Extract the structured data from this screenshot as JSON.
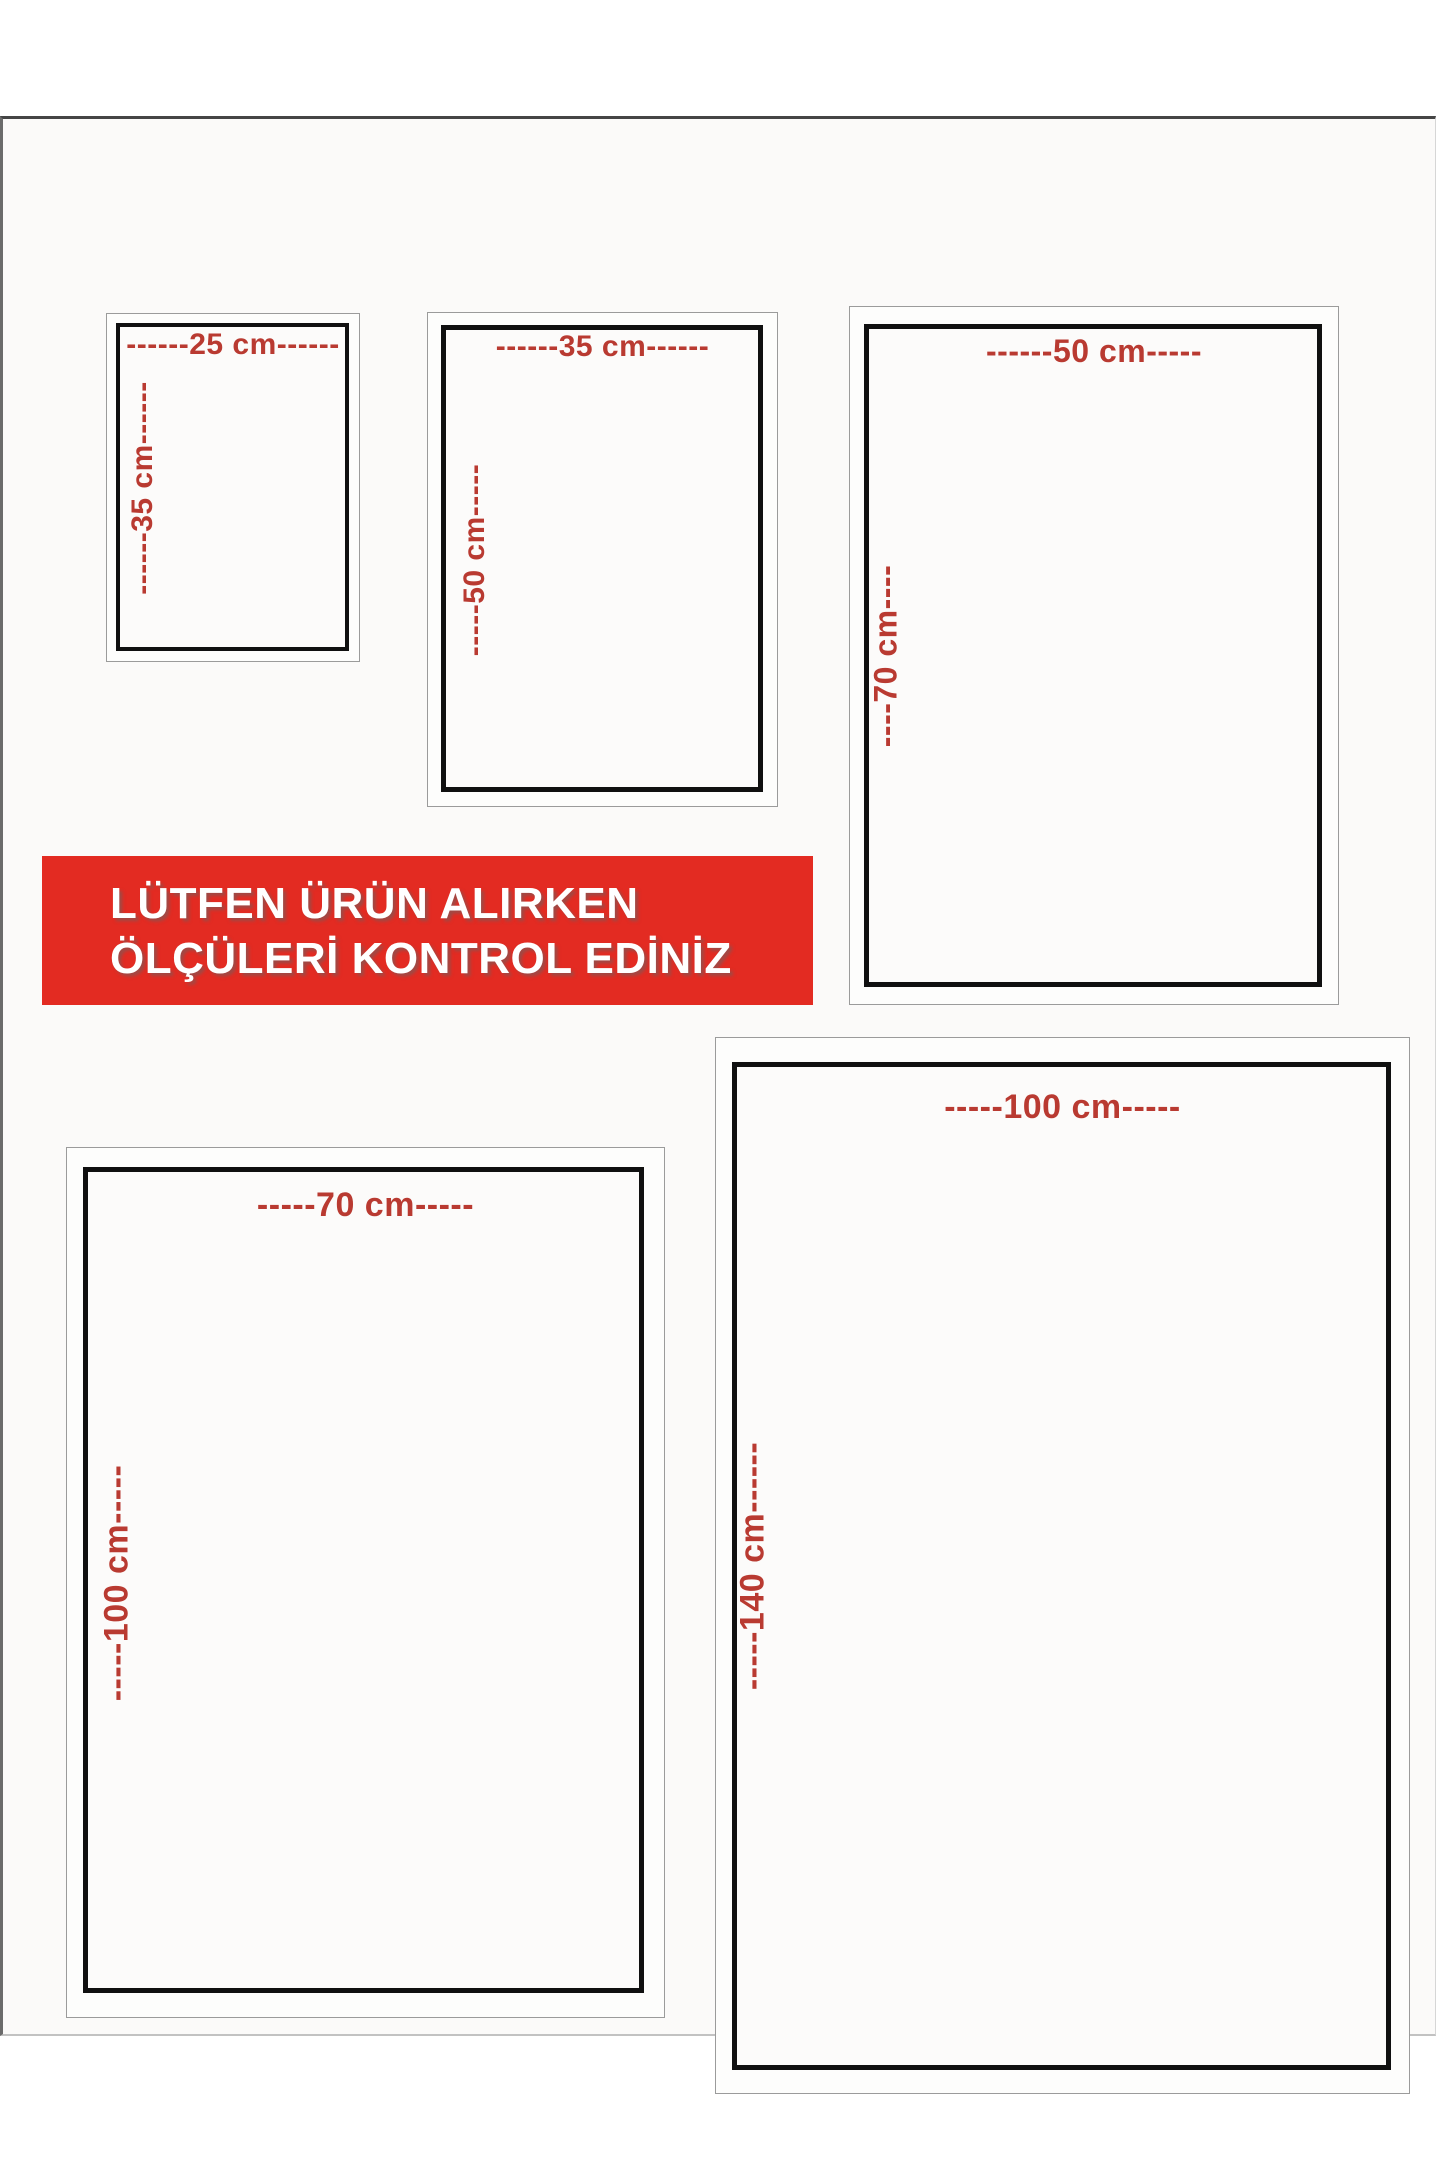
{
  "banner": {
    "line1": "LÜTFEN ÜRÜN ALIRKEN",
    "line2": "ÖLÇÜLERİ KONTROL EDİNİZ",
    "bg_color": "#e32b22",
    "text_color": "#ffffff"
  },
  "colors": {
    "dimension_label_red": "#b93a31",
    "inner_frame_black": "#101010",
    "outer_frame_gray": "#9b9b9b",
    "content_background": "#fbfaf9",
    "page_background": "#ffffff"
  },
  "sizes": [
    {
      "name": "25x35",
      "width_cm": 25,
      "height_cm": 35,
      "top_label": "------25 cm------",
      "side_label": "------35 cm------"
    },
    {
      "name": "35x50",
      "width_cm": 35,
      "height_cm": 50,
      "top_label": "------35 cm------",
      "side_label": "-----50 cm-----"
    },
    {
      "name": "50x70",
      "width_cm": 50,
      "height_cm": 70,
      "top_label": "------50 cm-----",
      "side_label": "----70 cm----"
    },
    {
      "name": "70x100",
      "width_cm": 70,
      "height_cm": 100,
      "top_label": "-----70 cm-----",
      "side_label": "-----100 cm-----"
    },
    {
      "name": "100x140",
      "width_cm": 100,
      "height_cm": 140,
      "top_label": "-----100 cm-----",
      "side_label": "-----140 cm------"
    }
  ]
}
